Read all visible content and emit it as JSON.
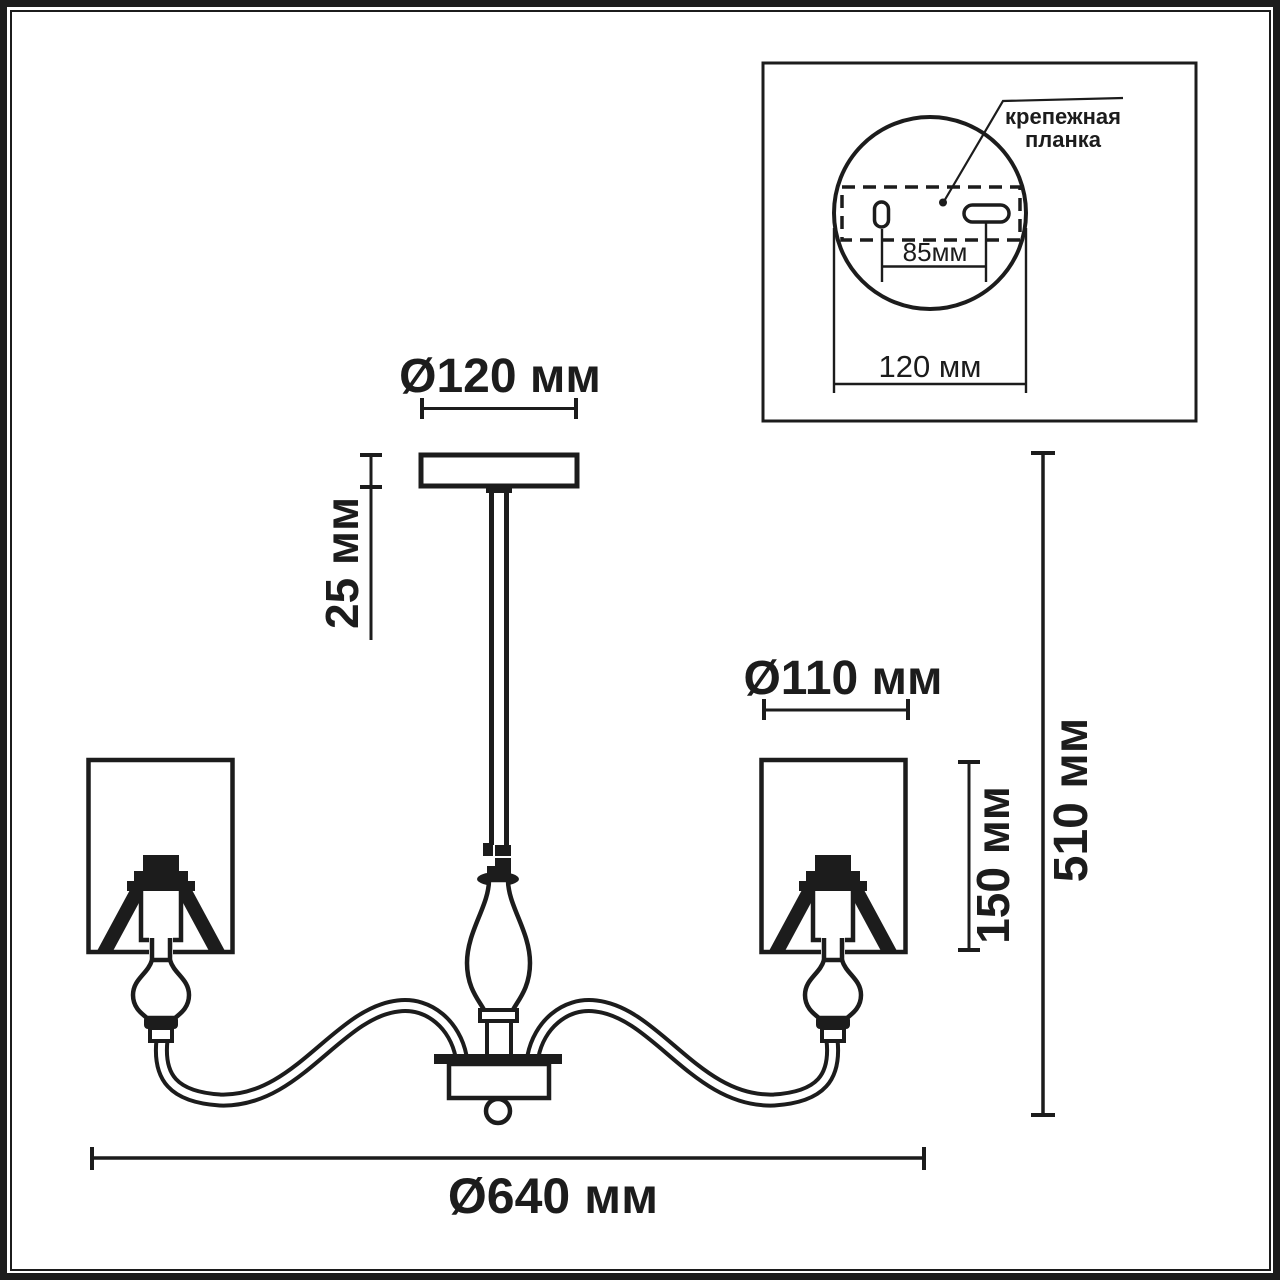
{
  "drawing": {
    "dimensions": {
      "canopy_diameter": "Ø120 мм",
      "canopy_height": "25 мм",
      "shade_diameter": "Ø110 мм",
      "shade_height": "150 мм",
      "fixture_height": "510 мм",
      "fixture_diameter": "Ø640 мм"
    },
    "inset": {
      "bracket_label": [
        "крепежная",
        "планка"
      ],
      "hole_spacing": "85мм",
      "plate_diameter": "120 мм"
    },
    "colors": {
      "line": "#1c1c1c",
      "background": "#ffffff"
    }
  }
}
